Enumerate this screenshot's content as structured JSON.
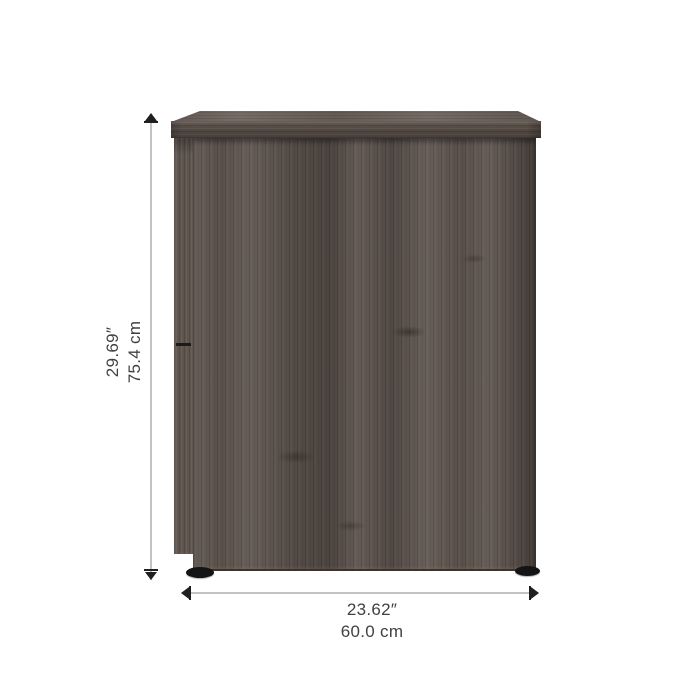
{
  "image": {
    "type": "product-dimension-diagram",
    "background": "#ffffff"
  },
  "product": {
    "name": "wood-cabinet-front-view",
    "finish_colors": {
      "panel_base": "#5e544e",
      "panel_dark_streak": "#463e39",
      "panel_light_streak": "#6f655e",
      "top_surface": "#6e635c",
      "top_front_edge": "#584e48",
      "glide_foot": "#141414"
    }
  },
  "annotations": {
    "height": {
      "imperial": "29.69″",
      "metric": "75.4 cm"
    },
    "width": {
      "imperial": "23.62″",
      "metric": "60.0 cm"
    },
    "line_color": "#c5c3c1",
    "arrow_color": "#1f1f1f",
    "text_color": "#414141"
  }
}
